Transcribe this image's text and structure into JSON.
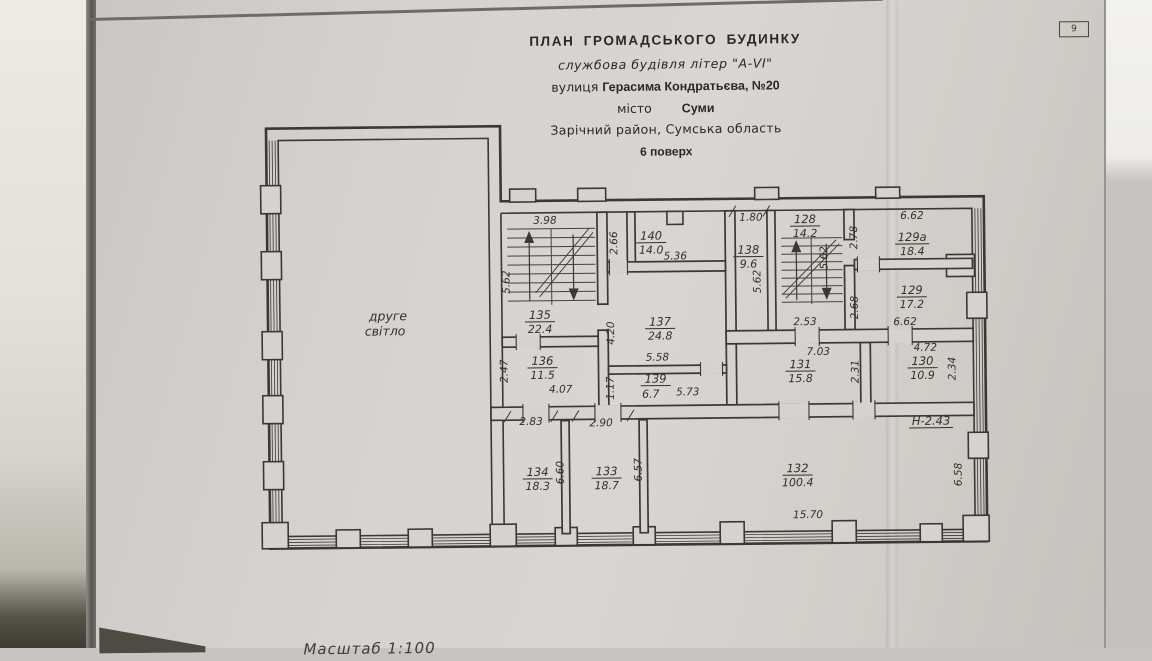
{
  "page": {
    "number": "9",
    "scale_note": "Масштаб 1:100"
  },
  "title_block": {
    "line1": "ПЛАН  ГРОМАДСЬКОГО  БУДИНКУ",
    "line2": "службова будівля літер \"А-VI\"",
    "street_label": "вулиця",
    "street_value": "Герасима Кондратьєва, №20",
    "city_label": "місто",
    "city_value": "Суми",
    "district_line": "Зарічний район, Сумська область",
    "floor_line": "6 поверх"
  },
  "plan": {
    "open_area_line1": "друге",
    "open_area_line2": "світло",
    "height_note": "Н-2.43",
    "rooms": {
      "r135": {
        "number": "135",
        "area": "22.4"
      },
      "r140": {
        "number": "140",
        "area": "14.0"
      },
      "r137": {
        "number": "137",
        "area": "24.8"
      },
      "r138": {
        "number": "138",
        "area": "9.6"
      },
      "r128": {
        "number": "128",
        "area": "14.2"
      },
      "r129a": {
        "number": "129а",
        "area": "18.4"
      },
      "r129": {
        "number": "129",
        "area": "17.2"
      },
      "r136": {
        "number": "136",
        "area": "11.5"
      },
      "r139": {
        "number": "139",
        "area": "6.7"
      },
      "r131": {
        "number": "131",
        "area": "15.8"
      },
      "r130": {
        "number": "130",
        "area": "10.9"
      },
      "r134": {
        "number": "134",
        "area": "18.3"
      },
      "r133": {
        "number": "133",
        "area": "18.7"
      },
      "r132": {
        "number": "132",
        "area": "100.4"
      }
    },
    "dims": {
      "stair135_top": "3.98",
      "stair135_left": "5.62",
      "lobby140_left": "2.66",
      "room140_width": "5.36",
      "room137_left": "4.20",
      "room137_width": "5.58",
      "room138_top": "1.80",
      "room138_right": "5.62",
      "stair128_right": "5.62",
      "stair128_bottom": "2.53",
      "room129a_top": "6.62",
      "room129a_left": "2.78",
      "room129_left": "2.68",
      "room129_bottom": "6.62",
      "room136_left": "2.47",
      "room136_bottom": "4.07",
      "room139_left": "1.17",
      "room139_right": "5.73",
      "room131_top": "7.03",
      "room131_right": "2.31",
      "room130_top": "4.72",
      "room130_right": "2.34",
      "room134_top": "2.83",
      "room134_right": "6.60",
      "room133_top": "2.90",
      "room133_right": "6.57",
      "room132_bottom": "15.70",
      "room132_right": "6.58"
    }
  }
}
